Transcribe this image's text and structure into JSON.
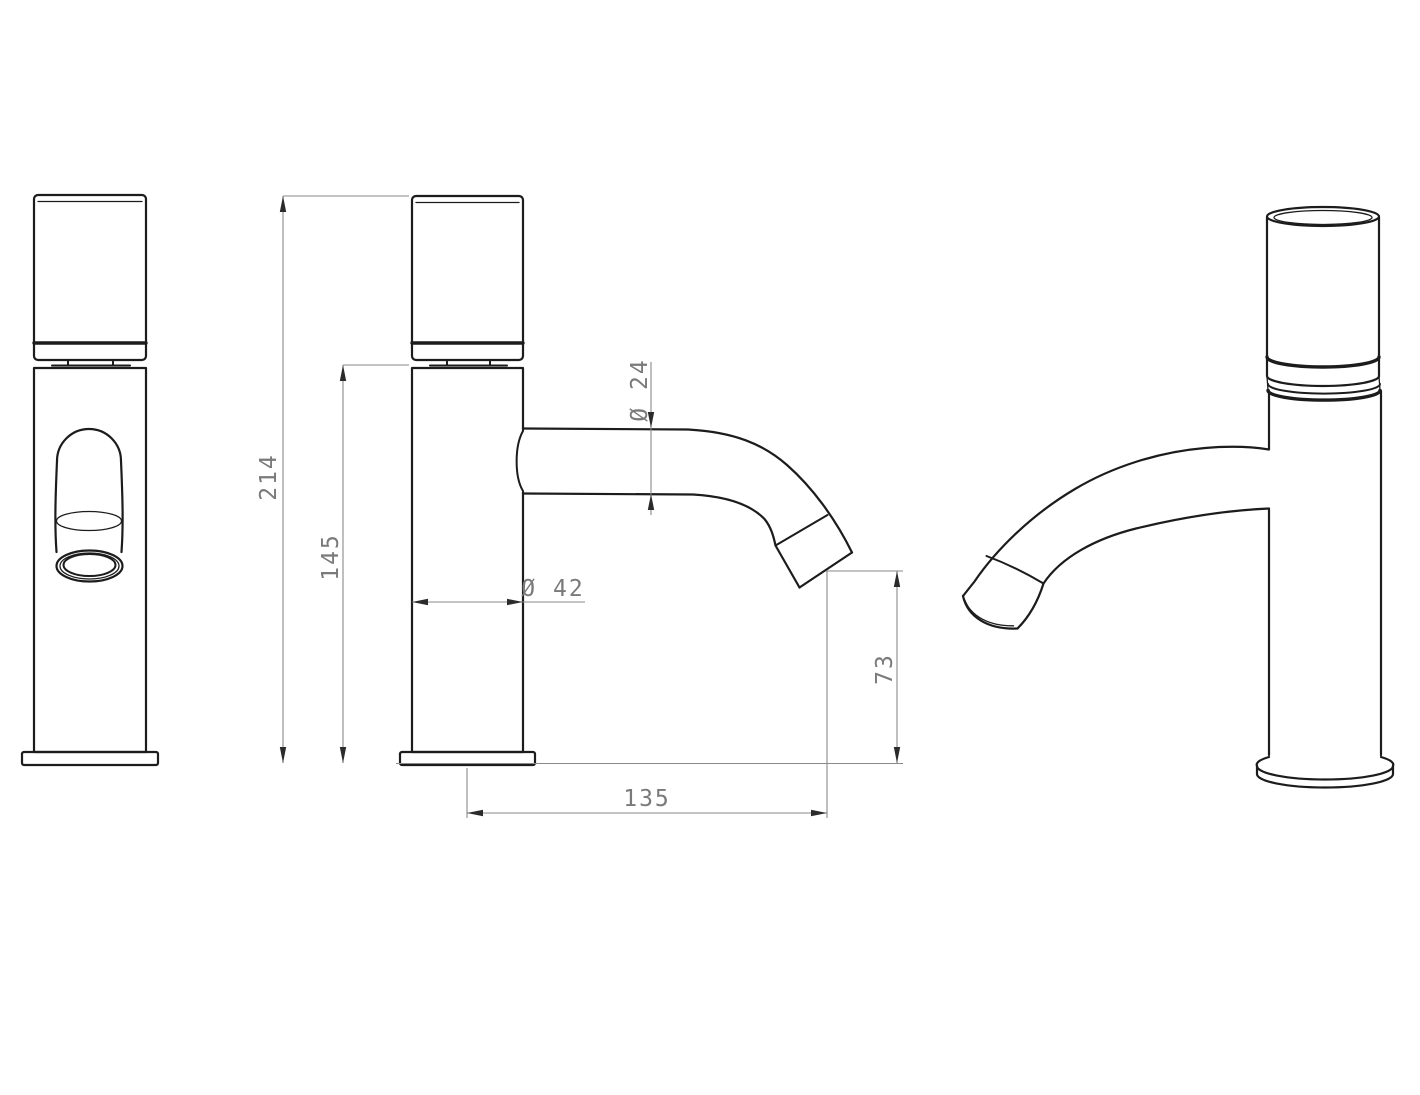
{
  "drawing": {
    "type": "technical-drawing",
    "subject": "single-lever basin faucet, three orthographic/perspective views",
    "views": {
      "front": "front-view",
      "side": "side-view-with-dimensions",
      "perspective": "perspective-view"
    },
    "dimensions": {
      "overall_height": "214",
      "body_height": "145",
      "body_diameter": "Ø 42",
      "spout_diameter": "Ø 24",
      "spout_outlet_height": "73",
      "spout_reach": "135"
    },
    "colors": {
      "outline": "#1c1c1c",
      "dimension_line": "#8a8a8a",
      "dimension_text": "#7a7a7a",
      "background": "#ffffff"
    }
  }
}
